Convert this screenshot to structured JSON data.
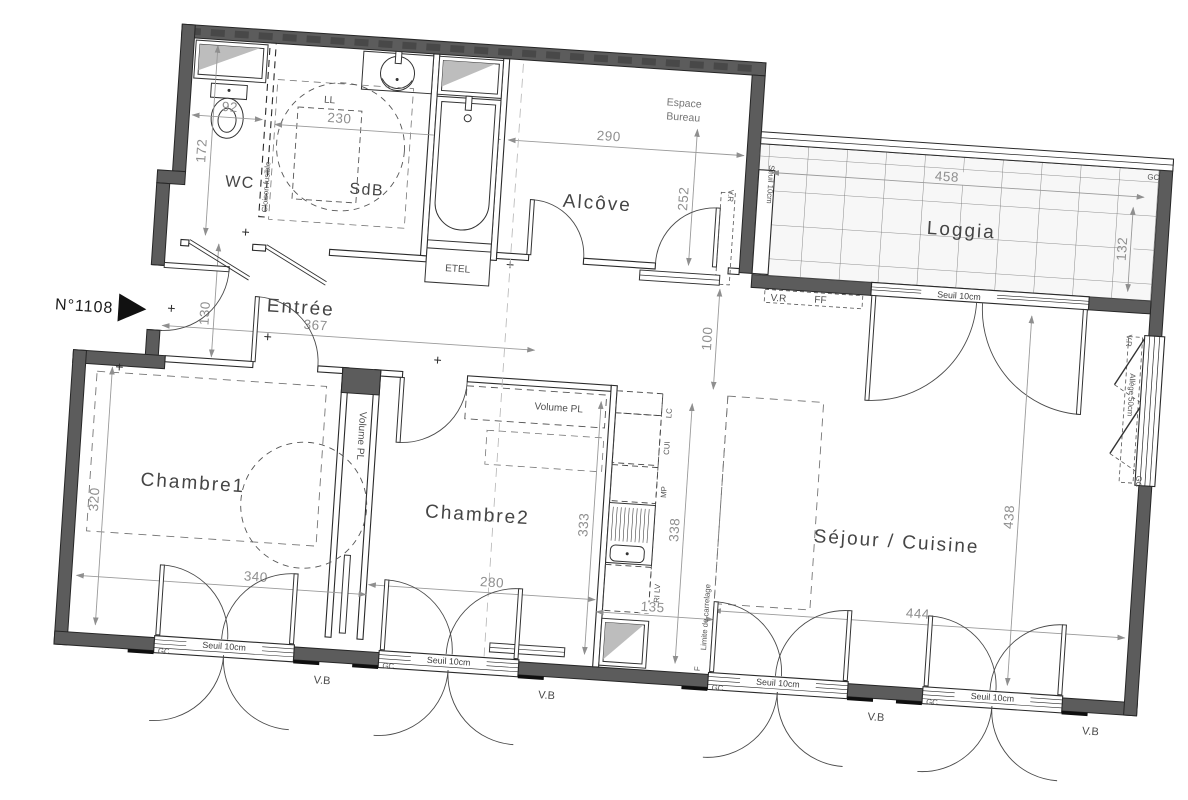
{
  "plan": {
    "unit_label": "N°1108",
    "rooms": {
      "wc": "WC",
      "sdb": "SdB",
      "alcove": "Alcôve",
      "loggia": "Loggia",
      "entree": "Entrée",
      "chambre1": "Chambre1",
      "chambre2": "Chambre2",
      "sejour": "Séjour / Cuisine"
    },
    "dimensions": {
      "wc_width": "92",
      "wc_depth": "172",
      "sdb_width": "230",
      "alcove_width": "290",
      "alcove_depth": "252",
      "loggia_width": "458",
      "loggia_depth": "132",
      "entree_length": "367",
      "entree_width": "130",
      "wall_gap": "100",
      "chambre1_depth": "320",
      "chambre1_width": "340",
      "chambre2_depth": "333",
      "chambre2_width": "280",
      "kitchen_length": "338",
      "kitchen_width": "135",
      "sejour_depth": "438",
      "sejour_width": "444"
    },
    "annotations": {
      "espace_bureau_1": "Espace",
      "espace_bureau_2": "Bureau",
      "cloison_fusible": "Cloison fusible",
      "volume_pl": "Volume PL",
      "ll": "LL",
      "etel": "ETEL",
      "lc": "LC",
      "cui": "CUI",
      "mp": "MP",
      "tri_lv": "TRI LV",
      "fridge": "F",
      "ff": "FF",
      "vr": "V.R",
      "vb": "V.B",
      "gc": "GC",
      "seuil": "Seuil 10cm",
      "allege": "Allège 50cm",
      "limite_carrelage": "Limite de carrelage",
      "plus": "+"
    },
    "colors": {
      "wall": "#5c5c5c",
      "line": "#2a2a2a",
      "dimension": "#8f8f8f",
      "label": "#454545",
      "background": "#ffffff"
    }
  }
}
